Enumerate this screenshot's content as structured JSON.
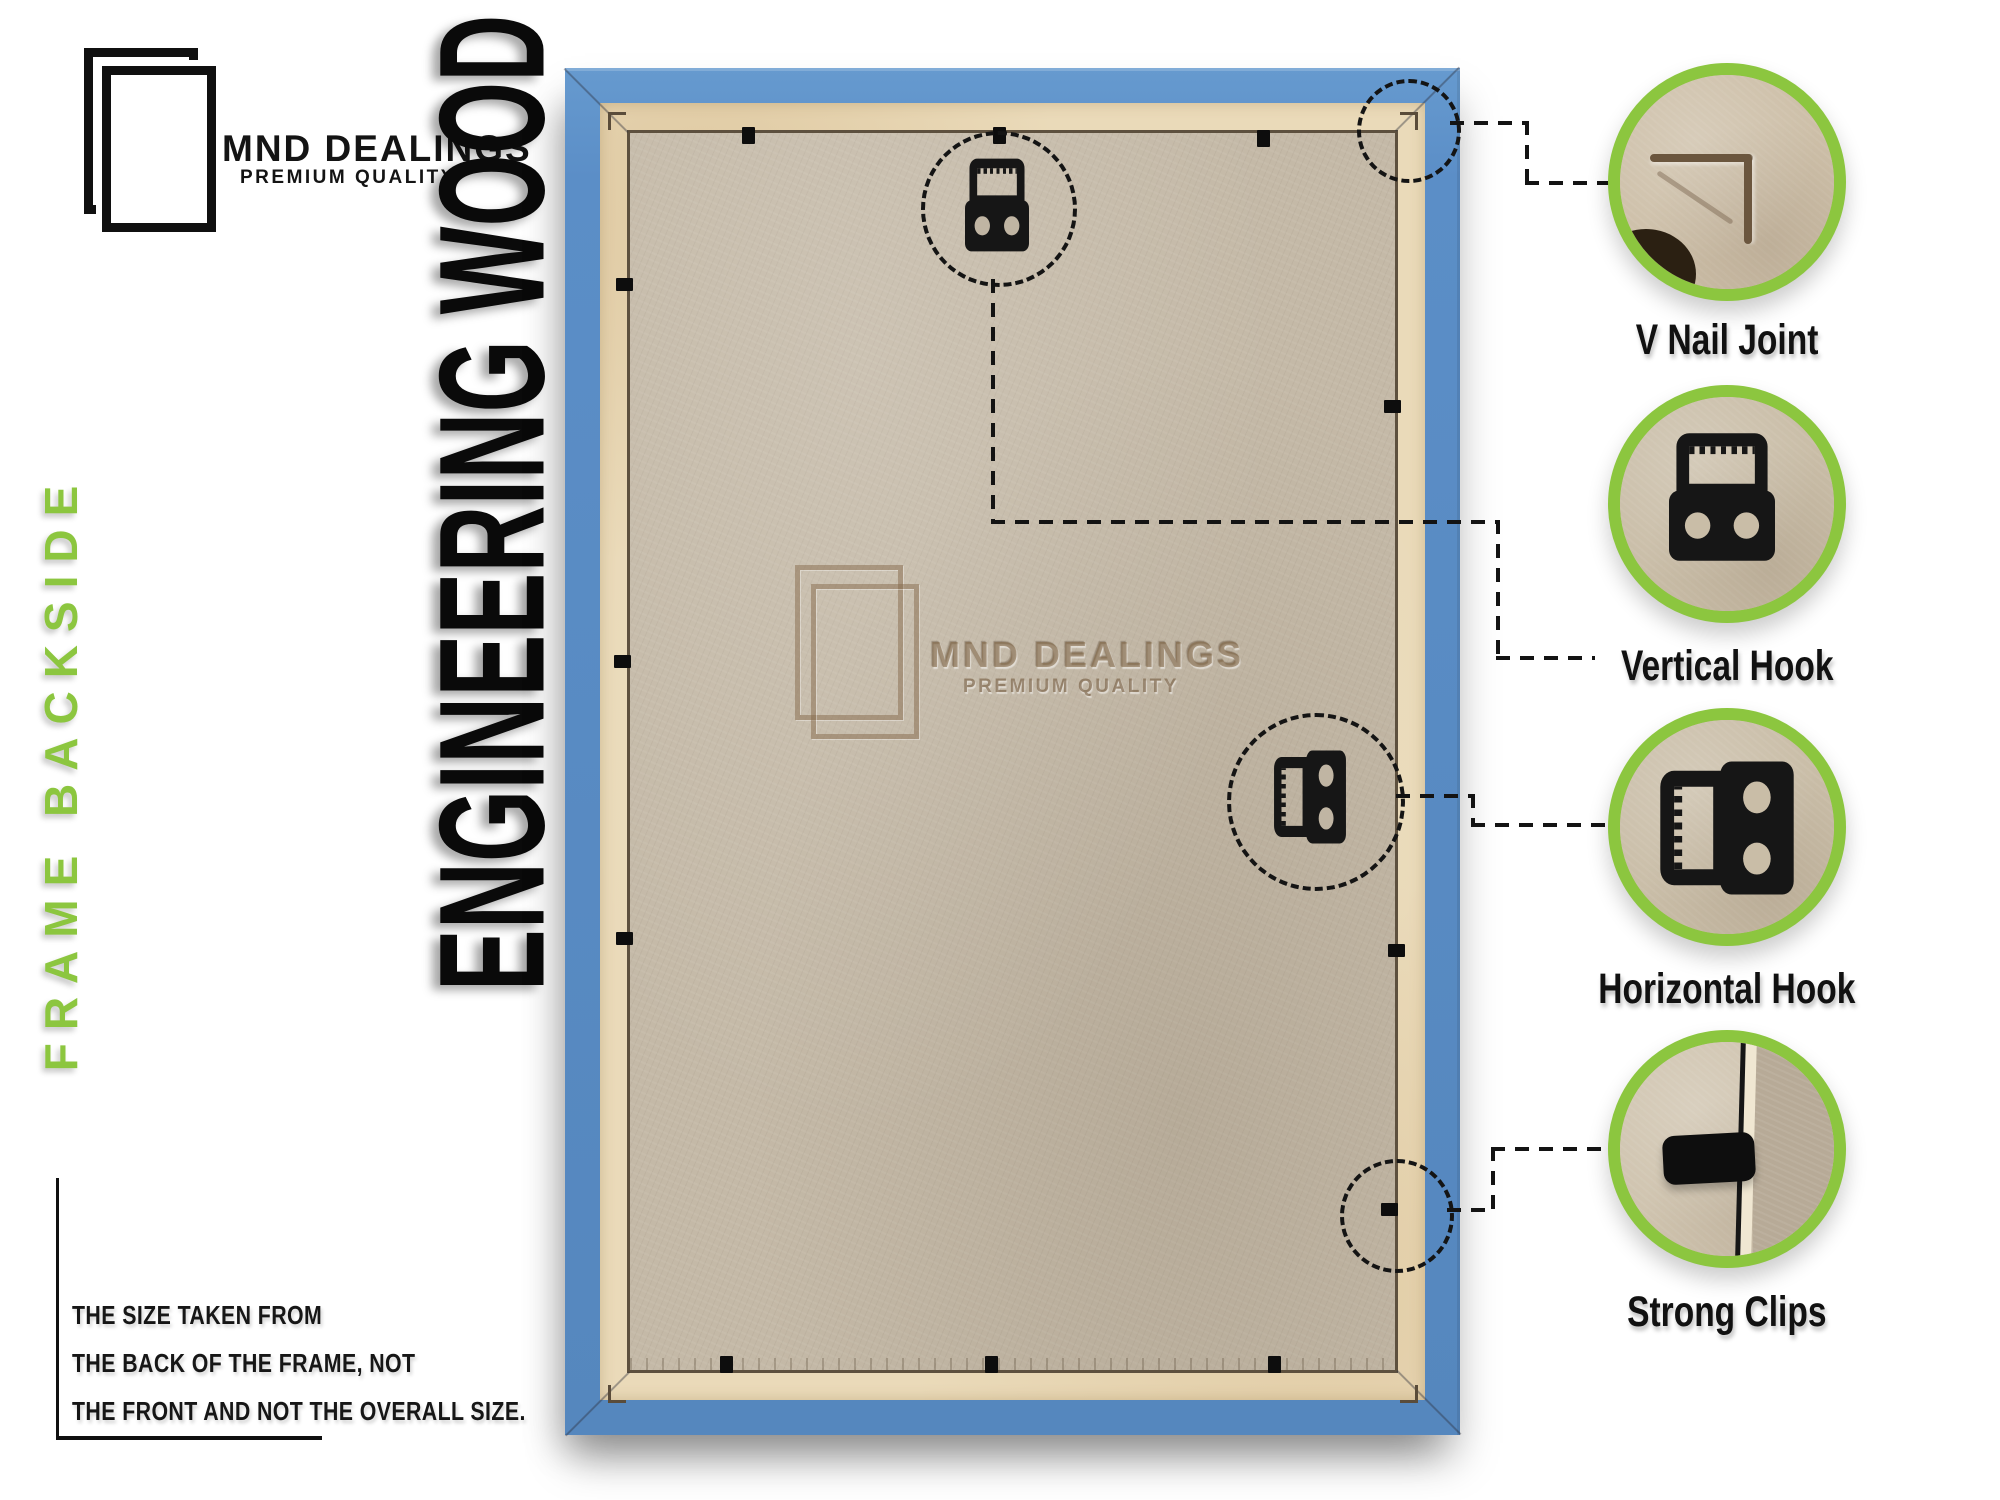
{
  "brand": {
    "name": "MND DEALINGS",
    "tagline": "PREMIUM QUALITY"
  },
  "side_label": "FRAME BACKSIDE",
  "material_label": "ENGINEERING WOOD",
  "note": {
    "lines": [
      "THE SIZE TAKEN FROM",
      "THE BACK OF THE FRAME, NOT",
      "THE FRONT AND NOT THE OVERALL SIZE."
    ]
  },
  "watermark": {
    "name": "MND DEALINGS",
    "tagline": "PREMIUM QUALITY"
  },
  "callouts": [
    {
      "id": "v-nail-joint",
      "label": "V Nail Joint"
    },
    {
      "id": "vertical-hook",
      "label": "Vertical Hook"
    },
    {
      "id": "horizontal-hook",
      "label": "Horizontal Hook"
    },
    {
      "id": "strong-clips",
      "label": "Strong Clips"
    }
  ],
  "colors": {
    "accent_green": "#8CC63F",
    "frame_blue": "#5B8EC7",
    "board_tan": "#C4B9A7",
    "lip_cream": "#EADAB9",
    "ink": "#111111"
  }
}
